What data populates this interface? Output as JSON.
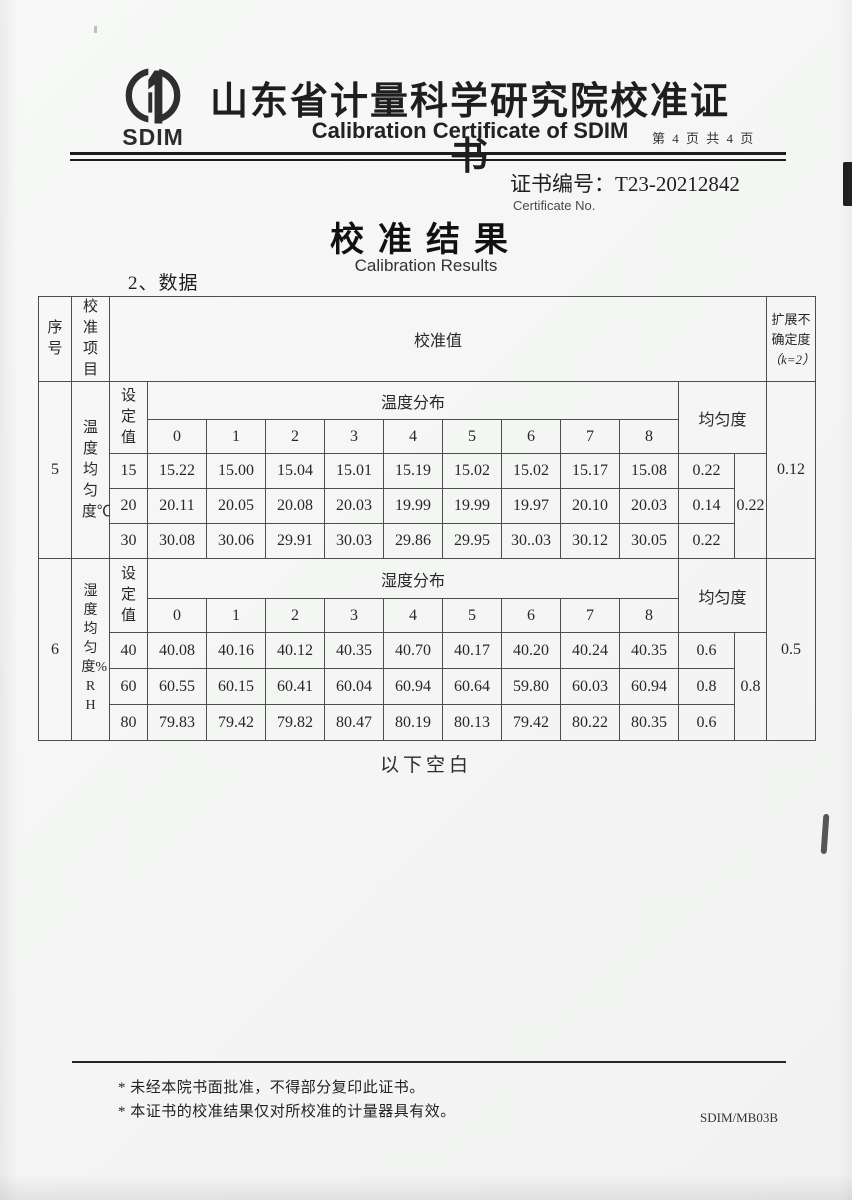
{
  "header": {
    "logo_text": "SDIM",
    "title_cn": "山东省计量科学研究院校准证书",
    "title_en": "Calibration Certificate of SDIM",
    "page_info": "第 4 页 共 4 页"
  },
  "certificate": {
    "number_label": "证书编号：",
    "number": "T23-20212842",
    "number_label_en": "Certificate No."
  },
  "results": {
    "title_cn": "校准结果",
    "title_en": "Calibration Results",
    "data_heading": "2、数据"
  },
  "table": {
    "col_headers": {
      "seq": "序号",
      "item": "校准项目",
      "value": "校准值",
      "uncertainty": "扩展不确定度",
      "uncertainty_k": "（k=2）",
      "setpoint": "设定值",
      "uniformity": "均匀度"
    },
    "temperature": {
      "seq": "5",
      "item": "温度均匀度℃",
      "dist_header": "温度分布",
      "positions": [
        "0",
        "1",
        "2",
        "3",
        "4",
        "5",
        "6",
        "7",
        "8"
      ],
      "rows": [
        {
          "set": "15",
          "values": [
            "15.22",
            "15.00",
            "15.04",
            "15.01",
            "15.19",
            "15.02",
            "15.02",
            "15.17",
            "15.08"
          ],
          "uniformity": "0.22"
        },
        {
          "set": "20",
          "values": [
            "20.11",
            "20.05",
            "20.08",
            "20.03",
            "19.99",
            "19.99",
            "19.97",
            "20.10",
            "20.03"
          ],
          "uniformity": "0.14"
        },
        {
          "set": "30",
          "values": [
            "30.08",
            "30.06",
            "29.91",
            "30.03",
            "29.86",
            "29.95",
            "30..03",
            "30.12",
            "30.05"
          ],
          "uniformity": "0.22"
        }
      ],
      "overall_uniformity": "0.22",
      "expanded_uncertainty": "0.12"
    },
    "humidity": {
      "seq": "6",
      "item": "湿度均匀度%RH",
      "dist_header": "湿度分布",
      "positions": [
        "0",
        "1",
        "2",
        "3",
        "4",
        "5",
        "6",
        "7",
        "8"
      ],
      "rows": [
        {
          "set": "40",
          "values": [
            "40.08",
            "40.16",
            "40.12",
            "40.35",
            "40.70",
            "40.17",
            "40.20",
            "40.24",
            "40.35"
          ],
          "uniformity": "0.6"
        },
        {
          "set": "60",
          "values": [
            "60.55",
            "60.15",
            "60.41",
            "60.04",
            "60.94",
            "60.64",
            "59.80",
            "60.03",
            "60.94"
          ],
          "uniformity": "0.8"
        },
        {
          "set": "80",
          "values": [
            "79.83",
            "79.42",
            "79.82",
            "80.47",
            "80.19",
            "80.13",
            "79.42",
            "80.22",
            "80.35"
          ],
          "uniformity": "0.6"
        }
      ],
      "overall_uniformity": "0.8",
      "expanded_uncertainty": "0.5"
    }
  },
  "blank_note": "以下空白",
  "footnotes": {
    "line1": "* 未经本院书面批准，不得部分复印此证书。",
    "line2": "* 本证书的校准结果仅对所校准的计量器具有效。"
  },
  "form_code": "SDIM/MB03B"
}
